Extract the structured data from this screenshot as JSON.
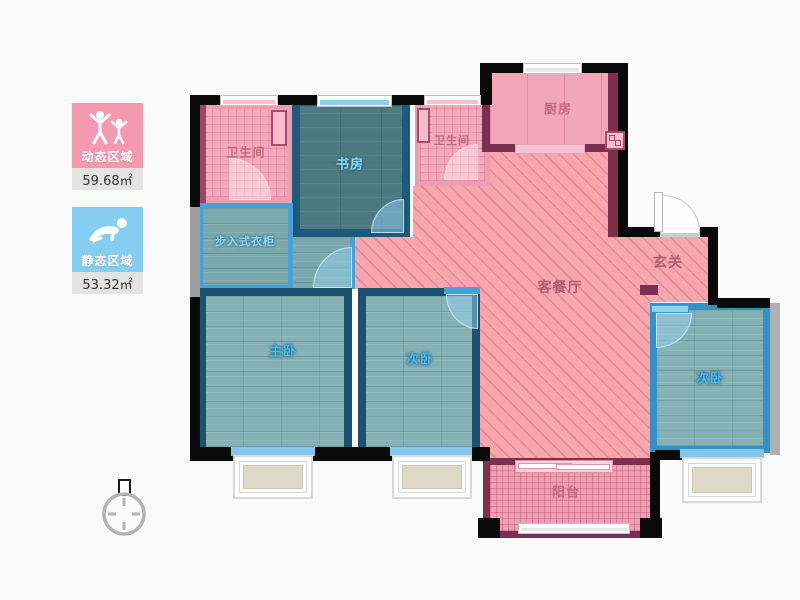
{
  "legend": {
    "dynamic": {
      "label": "动态区域",
      "value": "59.68㎡",
      "color": "#f49ab0",
      "icon": "people-arms-up-icon"
    },
    "static": {
      "label": "静态区域",
      "value": "53.32㎡",
      "color": "#85cdf1",
      "icon": "person-crawling-icon"
    }
  },
  "floorplan": {
    "rooms": {
      "bathroom_1": {
        "label": "卫生间"
      },
      "study": {
        "label": "书房"
      },
      "walk_in_closet": {
        "label": "步入式衣柜"
      },
      "bathroom_2": {
        "label": "卫生间"
      },
      "kitchen": {
        "label": "厨房"
      },
      "foyer": {
        "label": "玄关"
      },
      "living_dining": {
        "label": "客餐厅"
      },
      "master_bedroom": {
        "label": "主卧"
      },
      "bedroom_2": {
        "label": "次卧"
      },
      "bedroom_3": {
        "label": "次卧"
      },
      "balcony": {
        "label": "阳台"
      }
    },
    "colors": {
      "dynamic_area_floor": "#f6a6ae",
      "static_area_floor": "#86b1b4",
      "study_floor": "#4d7982",
      "bathroom_floor": "#f4aabe",
      "kitchen_wall": "#7c2f4f",
      "bedroom_wall": "#1a516e",
      "light_blue_wall": "#49a2d6",
      "outer_wall": "#0a0a0a"
    },
    "compass": {
      "icon": "north-compass-icon"
    }
  }
}
